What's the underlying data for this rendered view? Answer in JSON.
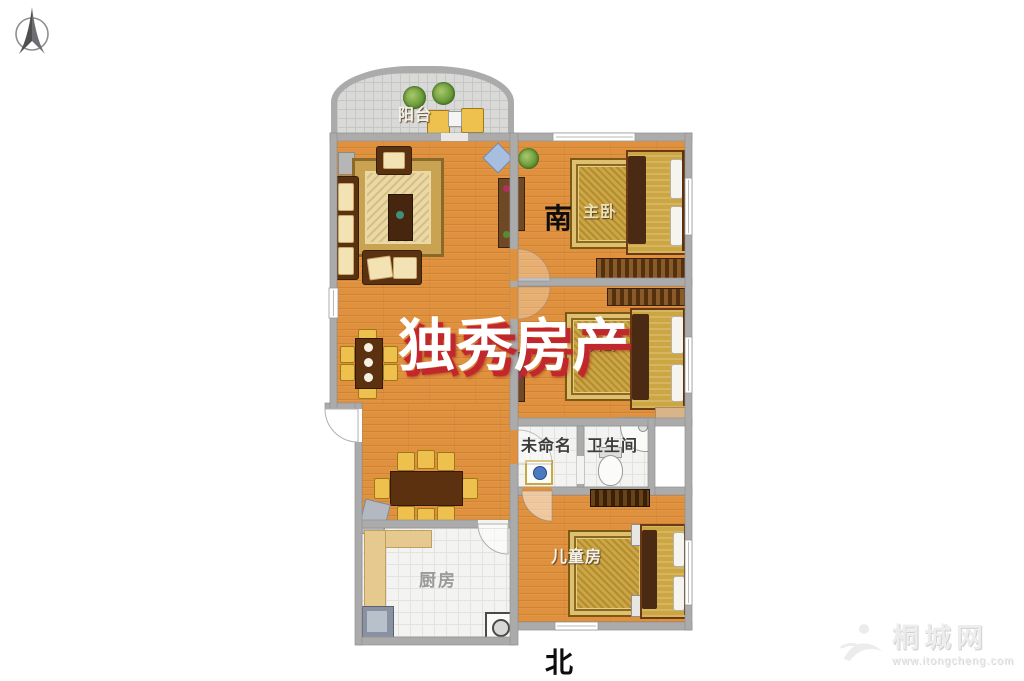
{
  "labels": {
    "balcony": "阳台",
    "master_bedroom": "主卧",
    "second_bedroom": "次卧",
    "unnamed_room": "未命名",
    "bathroom": "卫生间",
    "children_room": "儿童房",
    "kitchen": "厨房",
    "south": "南",
    "north": "北"
  },
  "watermark": {
    "agency": "独秀房产"
  },
  "site": {
    "name": "桐城网",
    "url": "www.itongcheng.com"
  },
  "icons": {
    "compass": "north-compass-icon",
    "plants": "potted-plant-icon",
    "toilet": "toilet-icon",
    "shower": "shower-icon",
    "stove": "stove-icon",
    "washer": "washing-machine-icon"
  },
  "colors": {
    "wood_floor": "#e0913e",
    "wall": "#ababab",
    "white_tile": "#f3f3f1",
    "balcony_tile": "#d9d9d7",
    "rug_gold": "#cda644",
    "watermark_red": "#c1272d"
  }
}
